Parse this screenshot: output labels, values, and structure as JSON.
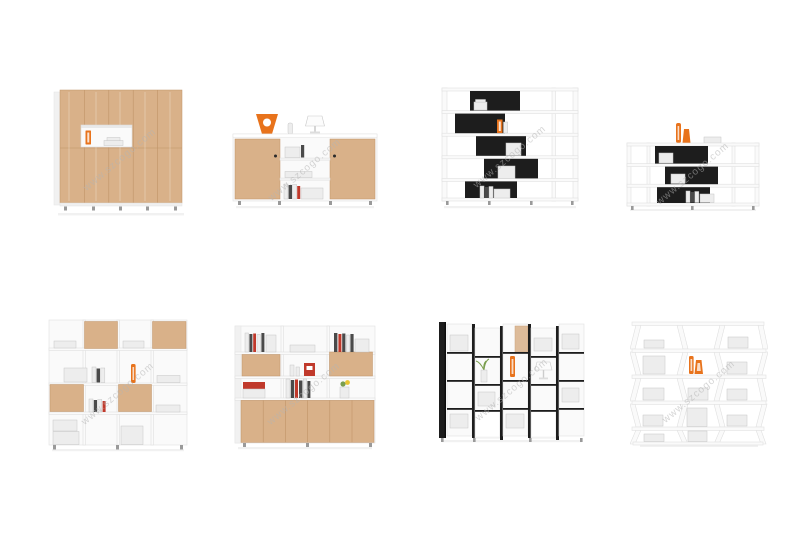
{
  "page": {
    "watermark": "www.szcogo.com",
    "background": "#ffffff"
  },
  "grid": {
    "rows": 2,
    "cols": 4
  },
  "colors": {
    "background": "#ffffff",
    "wood": "#d9b189",
    "wood_edge": "#c09468",
    "panel_border": "#e0e0e0",
    "black_panel": "#1d1d1d",
    "accent_orange": "#e8731c",
    "watermark_gray": "#b4b4b4",
    "book_red": "#c0392b",
    "plant_green": "#7a9e4e",
    "foot_gray": "#9a9a9a"
  },
  "products": [
    {
      "name": "tall beech wood filing cabinet with open display niche, orange vase and papers"
    },
    {
      "name": "beech sideboard with two wood doors, open middle shelves, orange sculpture and white lamp on top"
    },
    {
      "name": "tall white bookcase with five staggered black box shelves, books and orange file holder"
    },
    {
      "name": "low white bookcase with three staggered black box shelves and two orange vases on top"
    },
    {
      "name": "white cube bookcase with checkerboard beech doors, books and orange vase"
    },
    {
      "name": "white wall cabinet with beech lower doors, open upper shelves and beech flap fronts"
    },
    {
      "name": "black and white column bookcase with cube shelves, orange vase, lamp and plant"
    },
    {
      "name": "white zigzag wave bookcase with books and two orange vases"
    }
  ]
}
